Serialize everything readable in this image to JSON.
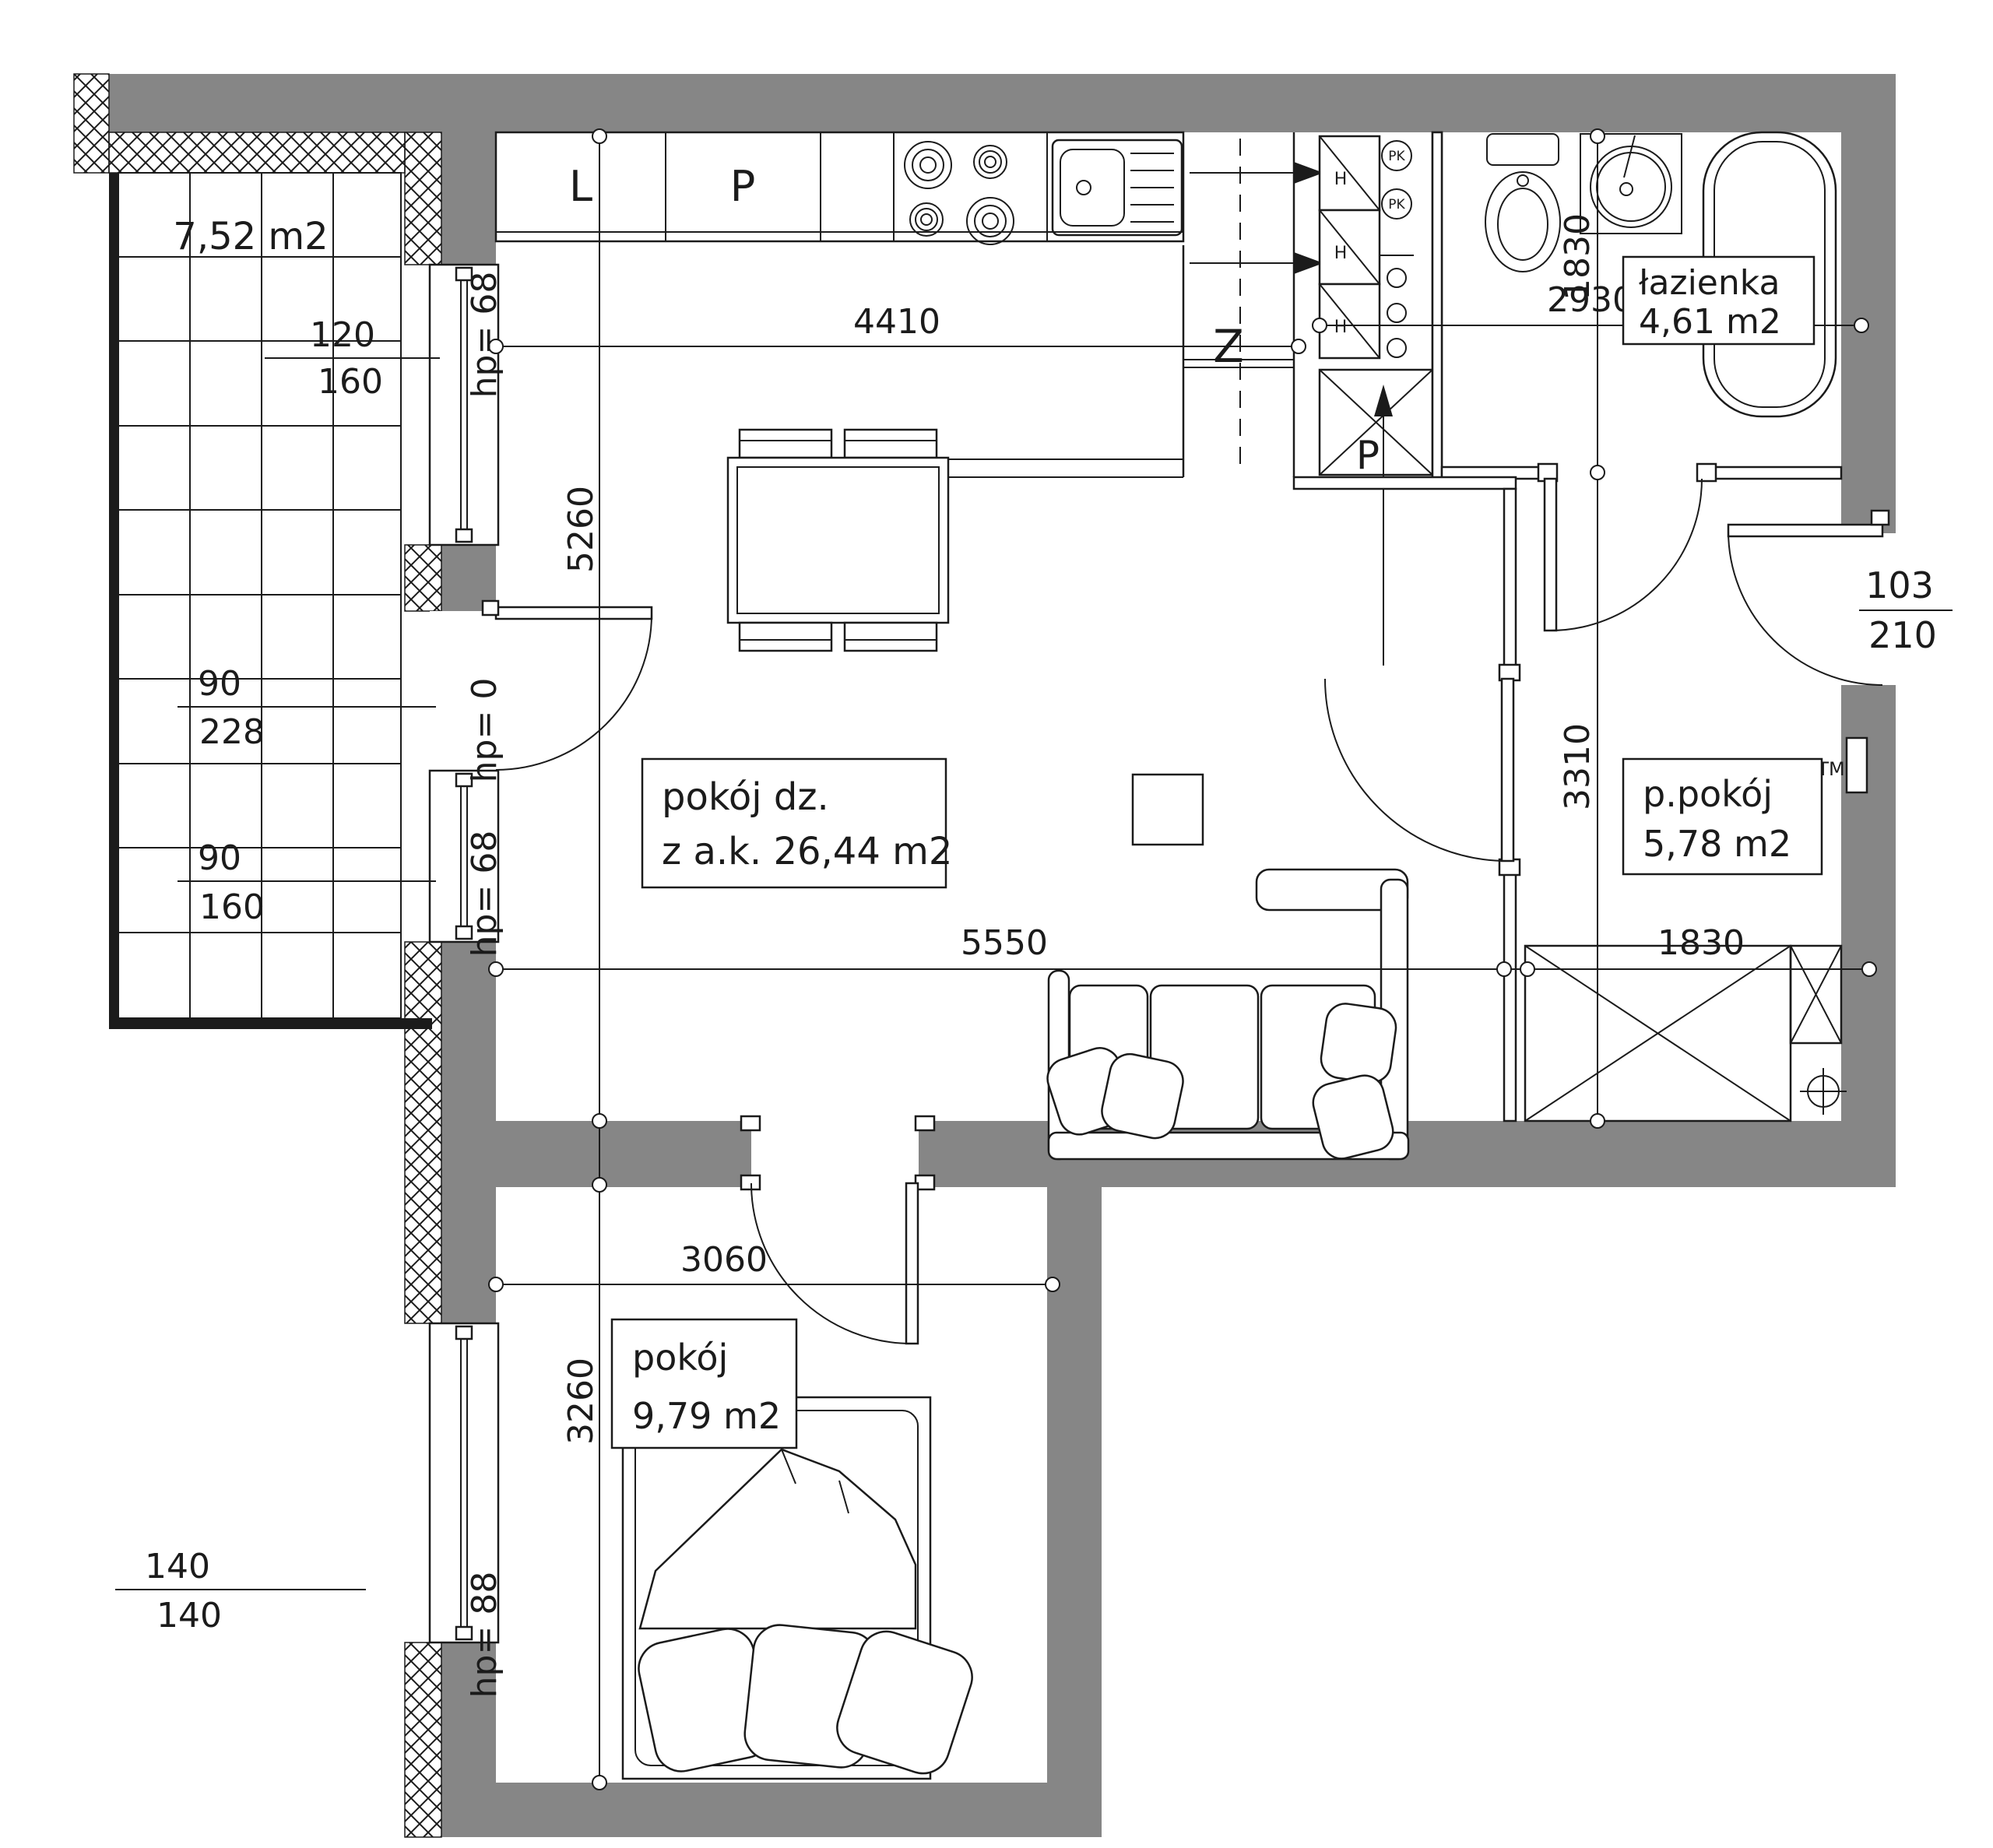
{
  "labels": {
    "balcony_area": "7,52 m2",
    "living": {
      "name": "pokój dz.",
      "area": "z a.k. 26,44 m2"
    },
    "bathroom": {
      "name": "łazienka",
      "area": "4,61 m2"
    },
    "hall": {
      "name": "p.pokój",
      "area": "5,78 m2"
    },
    "bedroom": {
      "name": "pokój",
      "area": "9,79 m2"
    }
  },
  "dims": {
    "kitchen_width": "4410",
    "bathroom_width": "2930",
    "living_width": "5550",
    "hall_width": "1830",
    "living_height": "5260",
    "bathroom_height": "1830",
    "hall_height": "3310",
    "bedroom_width": "3060",
    "bedroom_height": "3260"
  },
  "windows": {
    "w120": {
      "num": "120",
      "den": "160",
      "hp": "hp= 68"
    },
    "balcony_door": {
      "num": "90",
      "den": "228",
      "hp": "hp= 0"
    },
    "w90": {
      "num": "90",
      "den": "160",
      "hp": "hp= 68"
    },
    "w140": {
      "num": "140",
      "den": "140",
      "hp": "hp= 88"
    }
  },
  "entrance_door": {
    "num": "103",
    "den": "210"
  },
  "marks": {
    "kitchen_l": "L",
    "kitchen_p": "P",
    "closet": "Z",
    "shaft_p": "P",
    "duct": "H",
    "pk": "PK",
    "tm": "TM"
  },
  "colors": {
    "wall": "#868686",
    "line": "#1b1b1b",
    "bg": "#ffffff"
  }
}
